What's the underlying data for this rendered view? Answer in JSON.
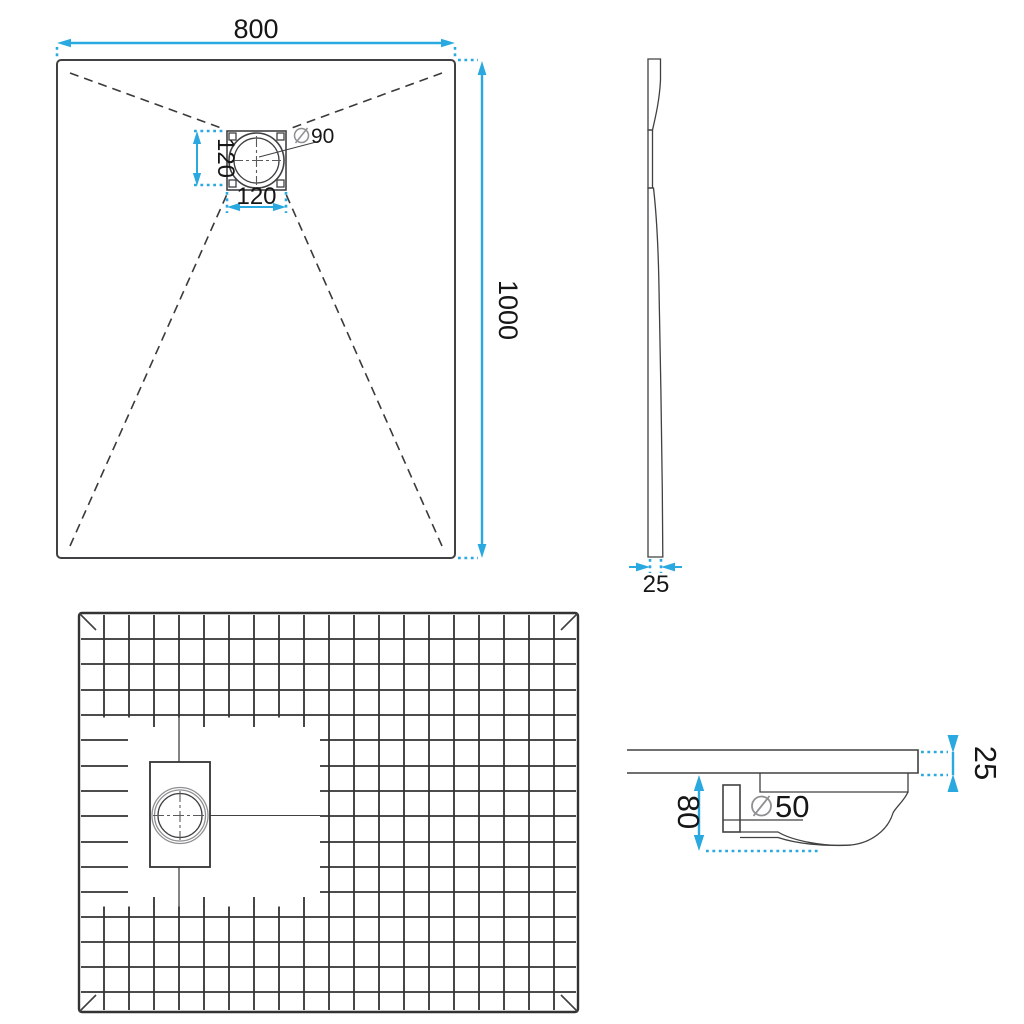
{
  "colors": {
    "accent": "#2AA9E0",
    "line": "#414042",
    "grid": "#333333",
    "muted": "#8f9092"
  },
  "top_view": {
    "width_mm": "800",
    "length_mm": "1000",
    "drain_box_width_mm": "120",
    "drain_box_height_mm": "120",
    "drain_diameter_mm": "90",
    "diameter_symbol": "⌀"
  },
  "side_view": {
    "thickness_mm": "25"
  },
  "section_view": {
    "installation_height_mm": "80",
    "waste_pipe_diameter_mm": "50",
    "thickness_mm": "25",
    "diameter_symbol": "⌀"
  }
}
